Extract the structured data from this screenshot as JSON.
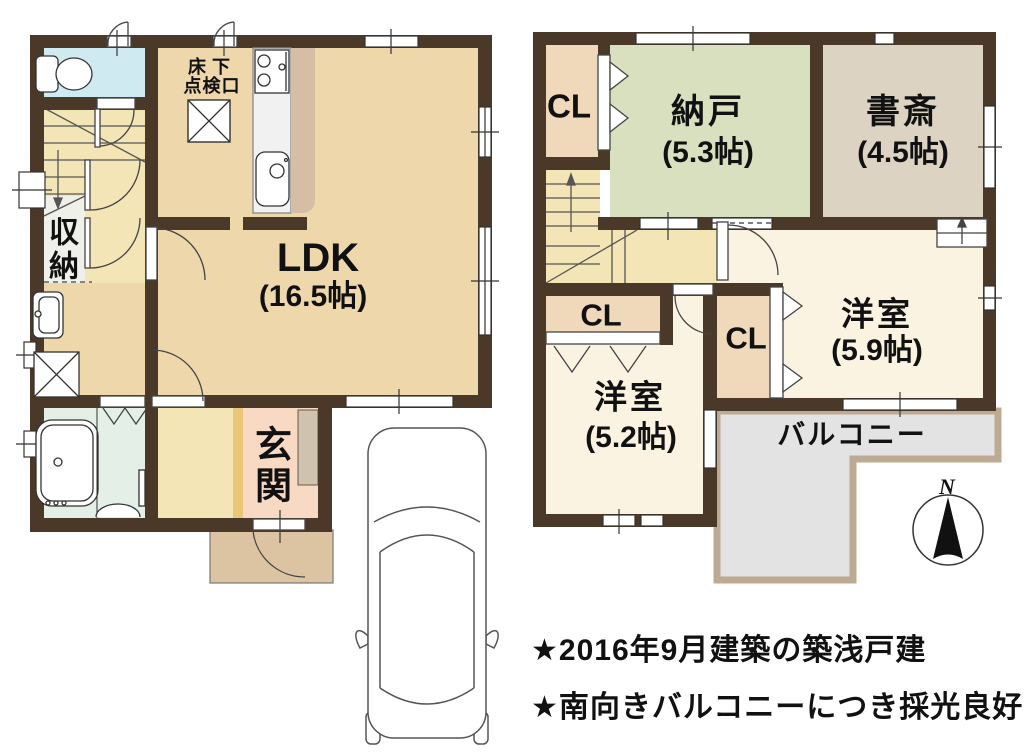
{
  "floor1": {
    "ldk": {
      "name": "LDK",
      "size": "(16.5帖)"
    },
    "genkan_label": "玄関",
    "storage_label": "収納",
    "hatch_label_line1": "床下",
    "hatch_label_line2": "点検口"
  },
  "floor2": {
    "closet_top_label": "CL",
    "closet_mid_label": "CL",
    "closet_bottom_label": "CL",
    "nando": {
      "name": "納戸",
      "size": "(5.3帖)"
    },
    "shosai": {
      "name": "書斎",
      "size": "(4.5帖)"
    },
    "yoshitsu_59": {
      "name": "洋室",
      "size": "(5.9帖)"
    },
    "yoshitsu_52": {
      "name": "洋室",
      "size": "(5.2帖)"
    },
    "balcony_label": "バルコニー"
  },
  "compass": {
    "north_label": "N"
  },
  "notes": {
    "line1": "★2016年9月建築の築浅戸建",
    "line2": "★南向きバルコニーにつき採光良好"
  },
  "colors": {
    "wall": "#4a3929",
    "ldk_floor": "#eed7ab",
    "hall_floor": "#f3e5b6",
    "toilet_floor": "#cfeaf0",
    "bath_floor": "#e3efe7",
    "storage_floor": "#f0f0ea",
    "genkan_floor": "#f7d9c4",
    "genkan_step": "#e8c878",
    "shoe_cabinet": "#cfc3b0",
    "porch_floor": "#dcc4a2",
    "kitchen_counter": "#d6bda6",
    "closet_floor": "#f0d8ba",
    "nando_floor": "#d8e0c0",
    "shosai_floor": "#dcd3c3",
    "yoshitsu_floor": "#faf3e1",
    "balcony_floor": "#e3e3e3",
    "balcony_border": "#bcab92",
    "text": "#111111"
  }
}
